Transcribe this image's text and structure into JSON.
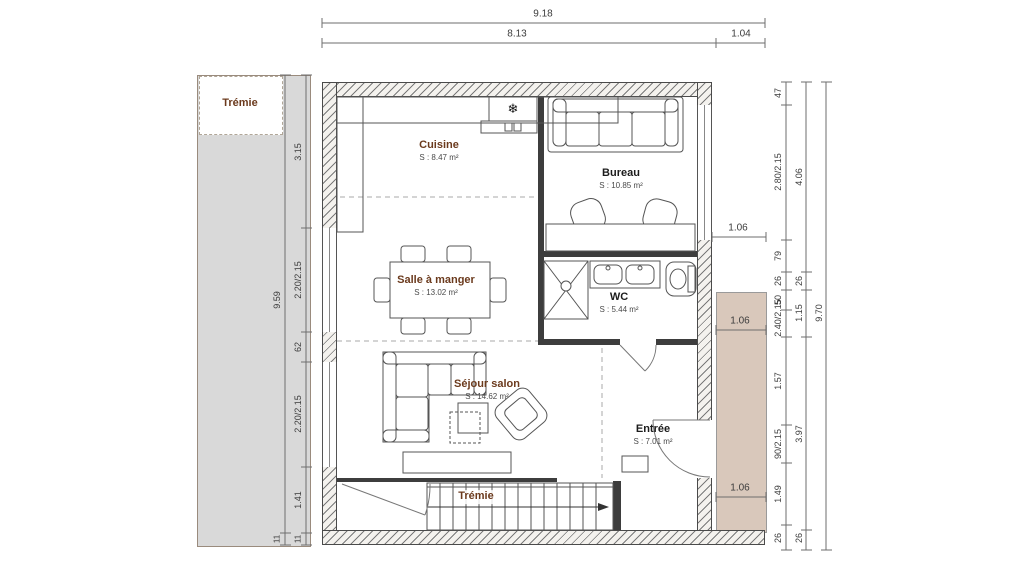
{
  "title": "Plan d'étage",
  "colors": {
    "wall_line": "#4a4a4a",
    "partition": "#3d3d3d",
    "terrace_gray": "#d9d9d9",
    "terrace_beige": "#d9c8bb",
    "room_brown": "#6b3a1d",
    "room_dark": "#1c1c1c",
    "dim_text": "#3c3c3c"
  },
  "rooms": {
    "cuisine": {
      "name": "Cuisine",
      "area": "S : 8.47 m²"
    },
    "bureau": {
      "name": "Bureau",
      "area": "S : 10.85 m²"
    },
    "salle_a_manger": {
      "name": "Salle à manger",
      "area": "S : 13.02 m²"
    },
    "wc": {
      "name": "WC",
      "area": "S : 5.44 m²"
    },
    "sejour_salon": {
      "name": "Séjour salon",
      "area": "S : 14.62 m²"
    },
    "entree": {
      "name": "Entrée",
      "area": "S : 7.01 m²"
    },
    "tremie_opening": {
      "name": "Trémie"
    },
    "tremie_stairs": {
      "name": "Trémie"
    }
  },
  "icons": {
    "fridge": "❄"
  },
  "dims": {
    "top_total": "9.18",
    "top_main": "8.13",
    "top_right": "1.04",
    "left_outer_total": "9.59",
    "left_outer_bottom": "11",
    "left_inner": [
      "3.15",
      "2.20/2.15",
      "62",
      "2.20/2.15",
      "1.41",
      "11"
    ],
    "right_inner": [
      "47",
      "2.80/2.15",
      "79",
      "26",
      "50",
      "2.40/2.15",
      "1.57",
      "90/2.15",
      "1.49",
      "26"
    ],
    "right_middle": [
      "4.06",
      "26",
      "1.15",
      "3.97",
      "26"
    ],
    "right_outer_total": "9.70",
    "offsets": [
      "1.06",
      "1.06",
      "1.06"
    ]
  }
}
